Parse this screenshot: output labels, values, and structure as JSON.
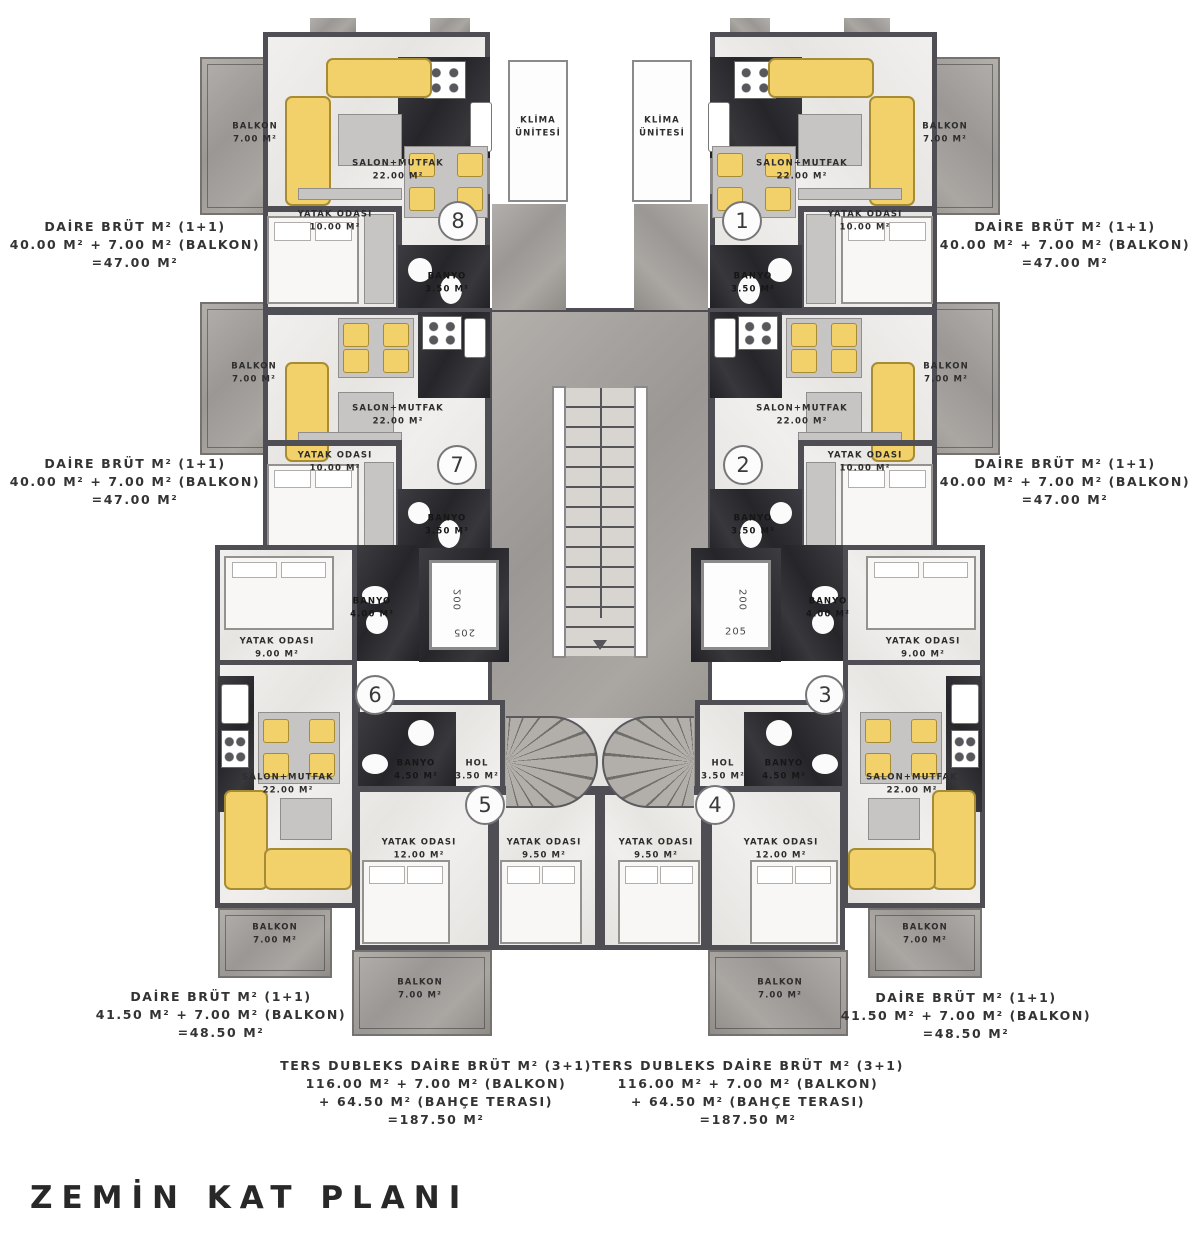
{
  "title": "ZEMİN KAT PLANI",
  "unit_numbers": [
    "1",
    "2",
    "3",
    "4",
    "5",
    "6",
    "7",
    "8"
  ],
  "rooms": {
    "salon": {
      "name": "SALON+MUTFAK",
      "area": "22.00 M²"
    },
    "yatak10": {
      "name": "YATAK ODASI",
      "area": "10.00 M²"
    },
    "yatak9": {
      "name": "YATAK ODASI",
      "area": "9.00 M²"
    },
    "yatak12": {
      "name": "YATAK ODASI",
      "area": "12.00 M²"
    },
    "yatak95": {
      "name": "YATAK ODASI",
      "area": "9.50 M²"
    },
    "banyo35": {
      "name": "BANYO",
      "area": "3.50 M²"
    },
    "banyo40": {
      "name": "BANYO",
      "area": "4.00 M²"
    },
    "banyo45": {
      "name": "BANYO",
      "area": "4.50 M²"
    },
    "hol": {
      "name": "HOL",
      "area": "3.50 M²"
    },
    "balkon": {
      "name": "BALKON",
      "area": "7.00 M²"
    },
    "klima": {
      "line1": "KLİMA",
      "line2": "ÜNİTESİ"
    },
    "elevator": {
      "top": "200",
      "bottom": "205"
    }
  },
  "annotations": {
    "apt40": {
      "l1": "DAİRE BRÜT M² (1+1)",
      "l2": "40.00 M² + 7.00 M² (BALKON)",
      "l3": "=47.00 M²"
    },
    "apt415": {
      "l1": "DAİRE BRÜT M² (1+1)",
      "l2": "41.50 M² + 7.00 M² (BALKON)",
      "l3": "=48.50 M²"
    },
    "duplex": {
      "l1": "TERS DUBLEKS DAİRE BRÜT M² (3+1)",
      "l2": "116.00 M² + 7.00 M² (BALKON)",
      "l3": "+  64.50 M² (BAHÇE TERASI)",
      "l4": "=187.50 M²"
    }
  },
  "colors": {
    "sofa": "#f2d06a",
    "wall": "#4e4e54",
    "floor": "#eae9e7",
    "dark_marble": "#2f2f32",
    "mid_marble": "#a7a3a0"
  }
}
